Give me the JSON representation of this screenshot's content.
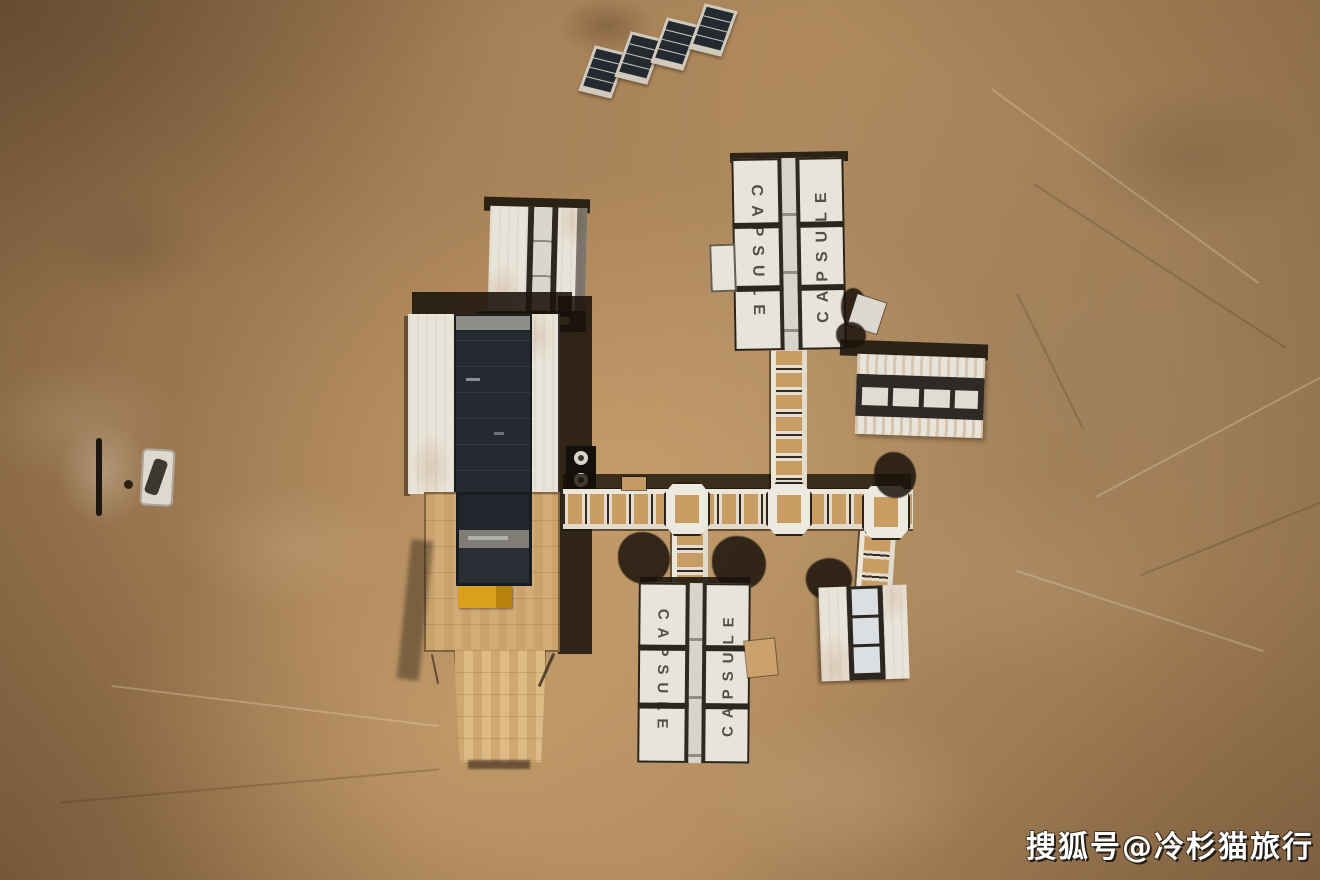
{
  "scene": {
    "watermark": "搜狐号@冷杉猫旅行",
    "capsule_label": "CAPSULE",
    "colors": {
      "desert_base": "#a57f56",
      "desert_dark": "#7c5e3f",
      "desert_light": "#c79e6a",
      "building_white": "#e9e4da",
      "panel_navy": "#252a31",
      "frame_dark": "#2b231a",
      "deck_tan": "#d2ac76",
      "corridor_tan": "#c89c62",
      "equipment_yellow": "#d99f1d",
      "rust": "#a9703a",
      "shadow": "#1f1710",
      "watermark_white": "#ffffff"
    }
  }
}
